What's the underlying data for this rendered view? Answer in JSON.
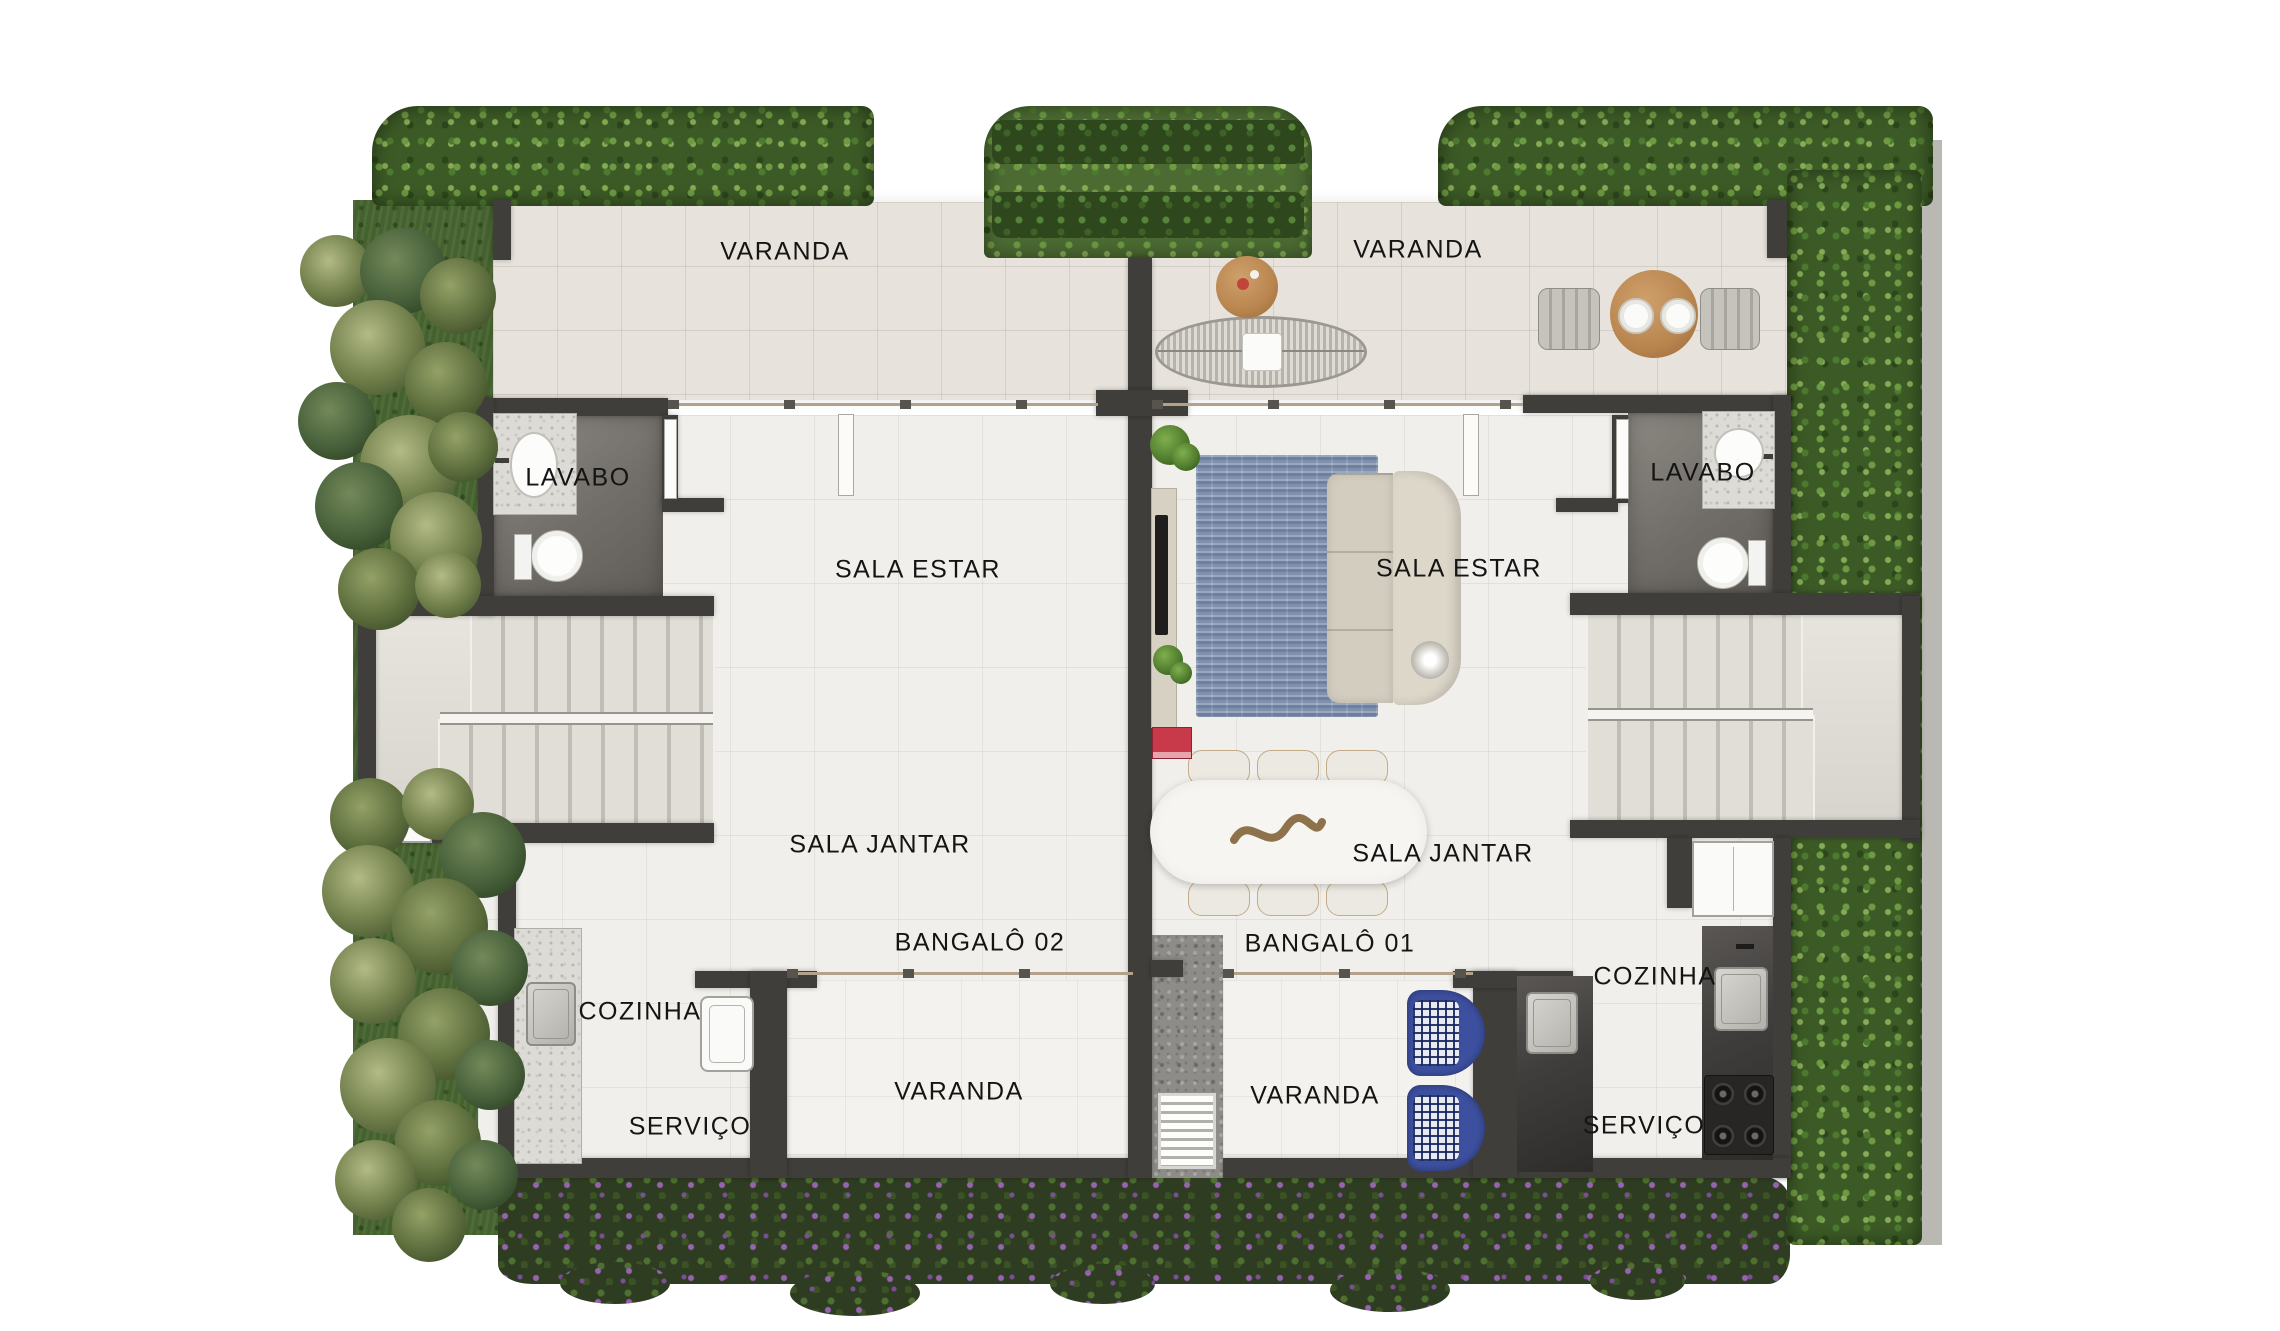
{
  "units": [
    {
      "name": "BANGALÔ 02",
      "rooms": {
        "varanda_top": "VARANDA",
        "lavabo": "LAVABO",
        "sala_estar": "SALA ESTAR",
        "sala_jantar": "SALA JANTAR",
        "cozinha": "COZINHA",
        "servico": "SERVIÇO",
        "varanda_bottom": "VARANDA"
      }
    },
    {
      "name": "BANGALÔ 01",
      "rooms": {
        "varanda_top": "VARANDA",
        "lavabo": "LAVABO",
        "sala_estar": "SALA ESTAR",
        "sala_jantar": "SALA JANTAR",
        "cozinha": "COZINHA",
        "servico": "SERVIÇO",
        "varanda_bottom": "VARANDA"
      }
    }
  ],
  "colors": {
    "wall": "#403e3b",
    "floor_varanda": "#e7e3dc",
    "floor_interior": "#f1efeb",
    "lavabo_floor": "#716d68",
    "hedge_green": "#3c5a26",
    "grass_green": "#45622e",
    "garden_flowers": "#9762b0",
    "rug_blue": "#7e90ad",
    "chair_blue": "#3d50a0",
    "wood": "#b9854f",
    "counter_dark": "#403e3c",
    "counter_light": "#dddbd5",
    "outer_wall": "#bab8b2",
    "label_text": "#141414"
  },
  "fixtures": [
    "hedge",
    "palm-tree",
    "flower-bed",
    "gravel-path",
    "drain-grate",
    "stairs",
    "toilet",
    "washbasin",
    "laundry-tub",
    "kitchen-sink",
    "stove",
    "fridge",
    "dining-table",
    "dining-chair",
    "outdoor-table",
    "outdoor-chair",
    "hammock",
    "side-table",
    "sofa",
    "rug",
    "tv",
    "sideboard",
    "plant",
    "books",
    "floor-lamp",
    "sliding-door",
    "door-leaf"
  ]
}
